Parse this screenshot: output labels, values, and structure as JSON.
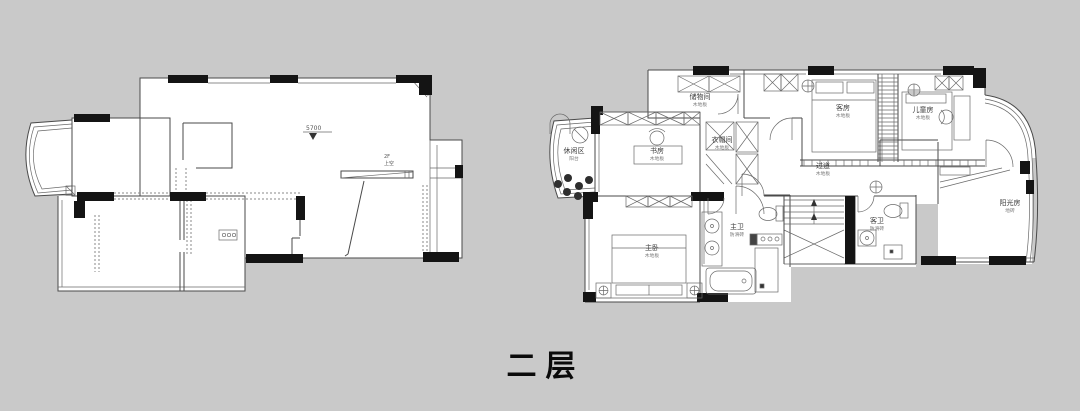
{
  "title": {
    "text": "二层"
  },
  "left_plan": {
    "level_marker": "5700",
    "stair_note": [
      "2F",
      "上空"
    ]
  },
  "right_plan": {
    "rooms": [
      {
        "id": "leisure-balcony",
        "name": "休闲区",
        "sub": "阳台"
      },
      {
        "id": "study",
        "name": "书房",
        "sub": "木地板"
      },
      {
        "id": "storage",
        "name": "储物间",
        "sub": "木地板"
      },
      {
        "id": "cloakroom",
        "name": "衣帽间",
        "sub": "木地板"
      },
      {
        "id": "guest-room",
        "name": "客房",
        "sub": "木地板"
      },
      {
        "id": "kids-room",
        "name": "儿童房",
        "sub": "木地板"
      },
      {
        "id": "hallway",
        "name": "过道",
        "sub": "木地板"
      },
      {
        "id": "master-bedroom",
        "name": "主卧",
        "sub": "木地板"
      },
      {
        "id": "master-bath",
        "name": "主卫",
        "sub": "防滑砖"
      },
      {
        "id": "guest-bath",
        "name": "客卫",
        "sub": "防滑砖"
      },
      {
        "id": "sunroom",
        "name": "阳光房",
        "sub": "地砖"
      }
    ]
  }
}
